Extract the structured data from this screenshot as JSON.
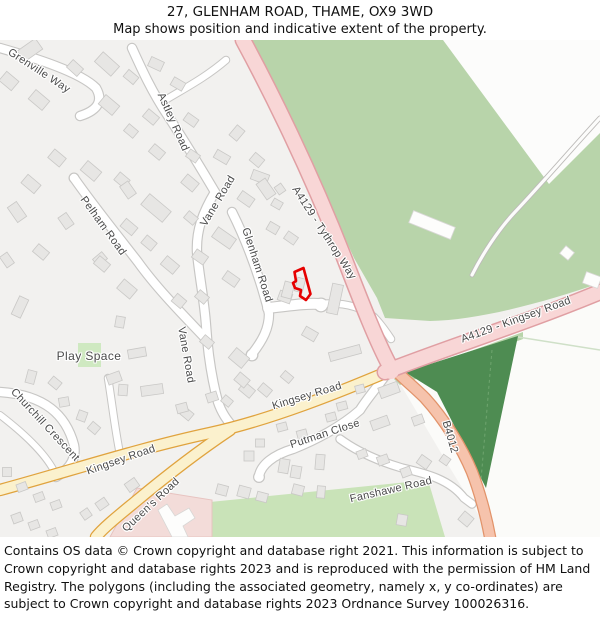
{
  "header": {
    "title": "27, GLENHAM ROAD, THAME, OX9 3WD",
    "subtitle": "Map shows position and indicative extent of the property."
  },
  "map": {
    "road_labels": {
      "grenville_way": "Grenville Way",
      "astley_road": "Astley Road",
      "pelham_road": "Pelham Road",
      "vane_road_upper": "Vane Road",
      "vane_road_lower": "Vane Road",
      "glenham_road": "Glenham Road",
      "a4129_tythrop_way": "A4129 - Tythrop Way",
      "a4129_kingsey_road": "A4129 - Kingsey Road",
      "b4012": "B4012",
      "kingsey_road_upper": "Kingsey Road",
      "kingsey_road_lower": "Kingsey Road",
      "queens_road": "Queen's Road",
      "churchill_crescent": "Churchill Crescent",
      "putman_close": "Putman Close",
      "fanshawe_road": "Fanshawe Road"
    },
    "area_labels": {
      "play_space": "Play Space"
    },
    "colors": {
      "property_outline": "#e60000",
      "trunk_road_fill": "#f8d6d6",
      "trunk_road_casing": "#e09fa3",
      "b_road_fill": "#f6c3ac",
      "b_road_casing": "#e2936a",
      "secondary_road_fill": "#fbf1cd",
      "secondary_road_casing": "#e0a33e",
      "woodland_green": "#4e8c52",
      "grass_green": "#b8d4aa",
      "field_green": "#c9e3b8",
      "play_space_green": "#cfe9c1",
      "school_grounds_pink": "#f3dcd9"
    }
  },
  "footer": {
    "text": "Contains OS data © Crown copyright and database right 2021. This information is subject to Crown copyright and database rights 2023 and is reproduced with the permission of HM Land Registry. The polygons (including the associated geometry, namely x, y co-ordinates) are subject to Crown copyright and database rights 2023 Ordnance Survey 100026316."
  }
}
